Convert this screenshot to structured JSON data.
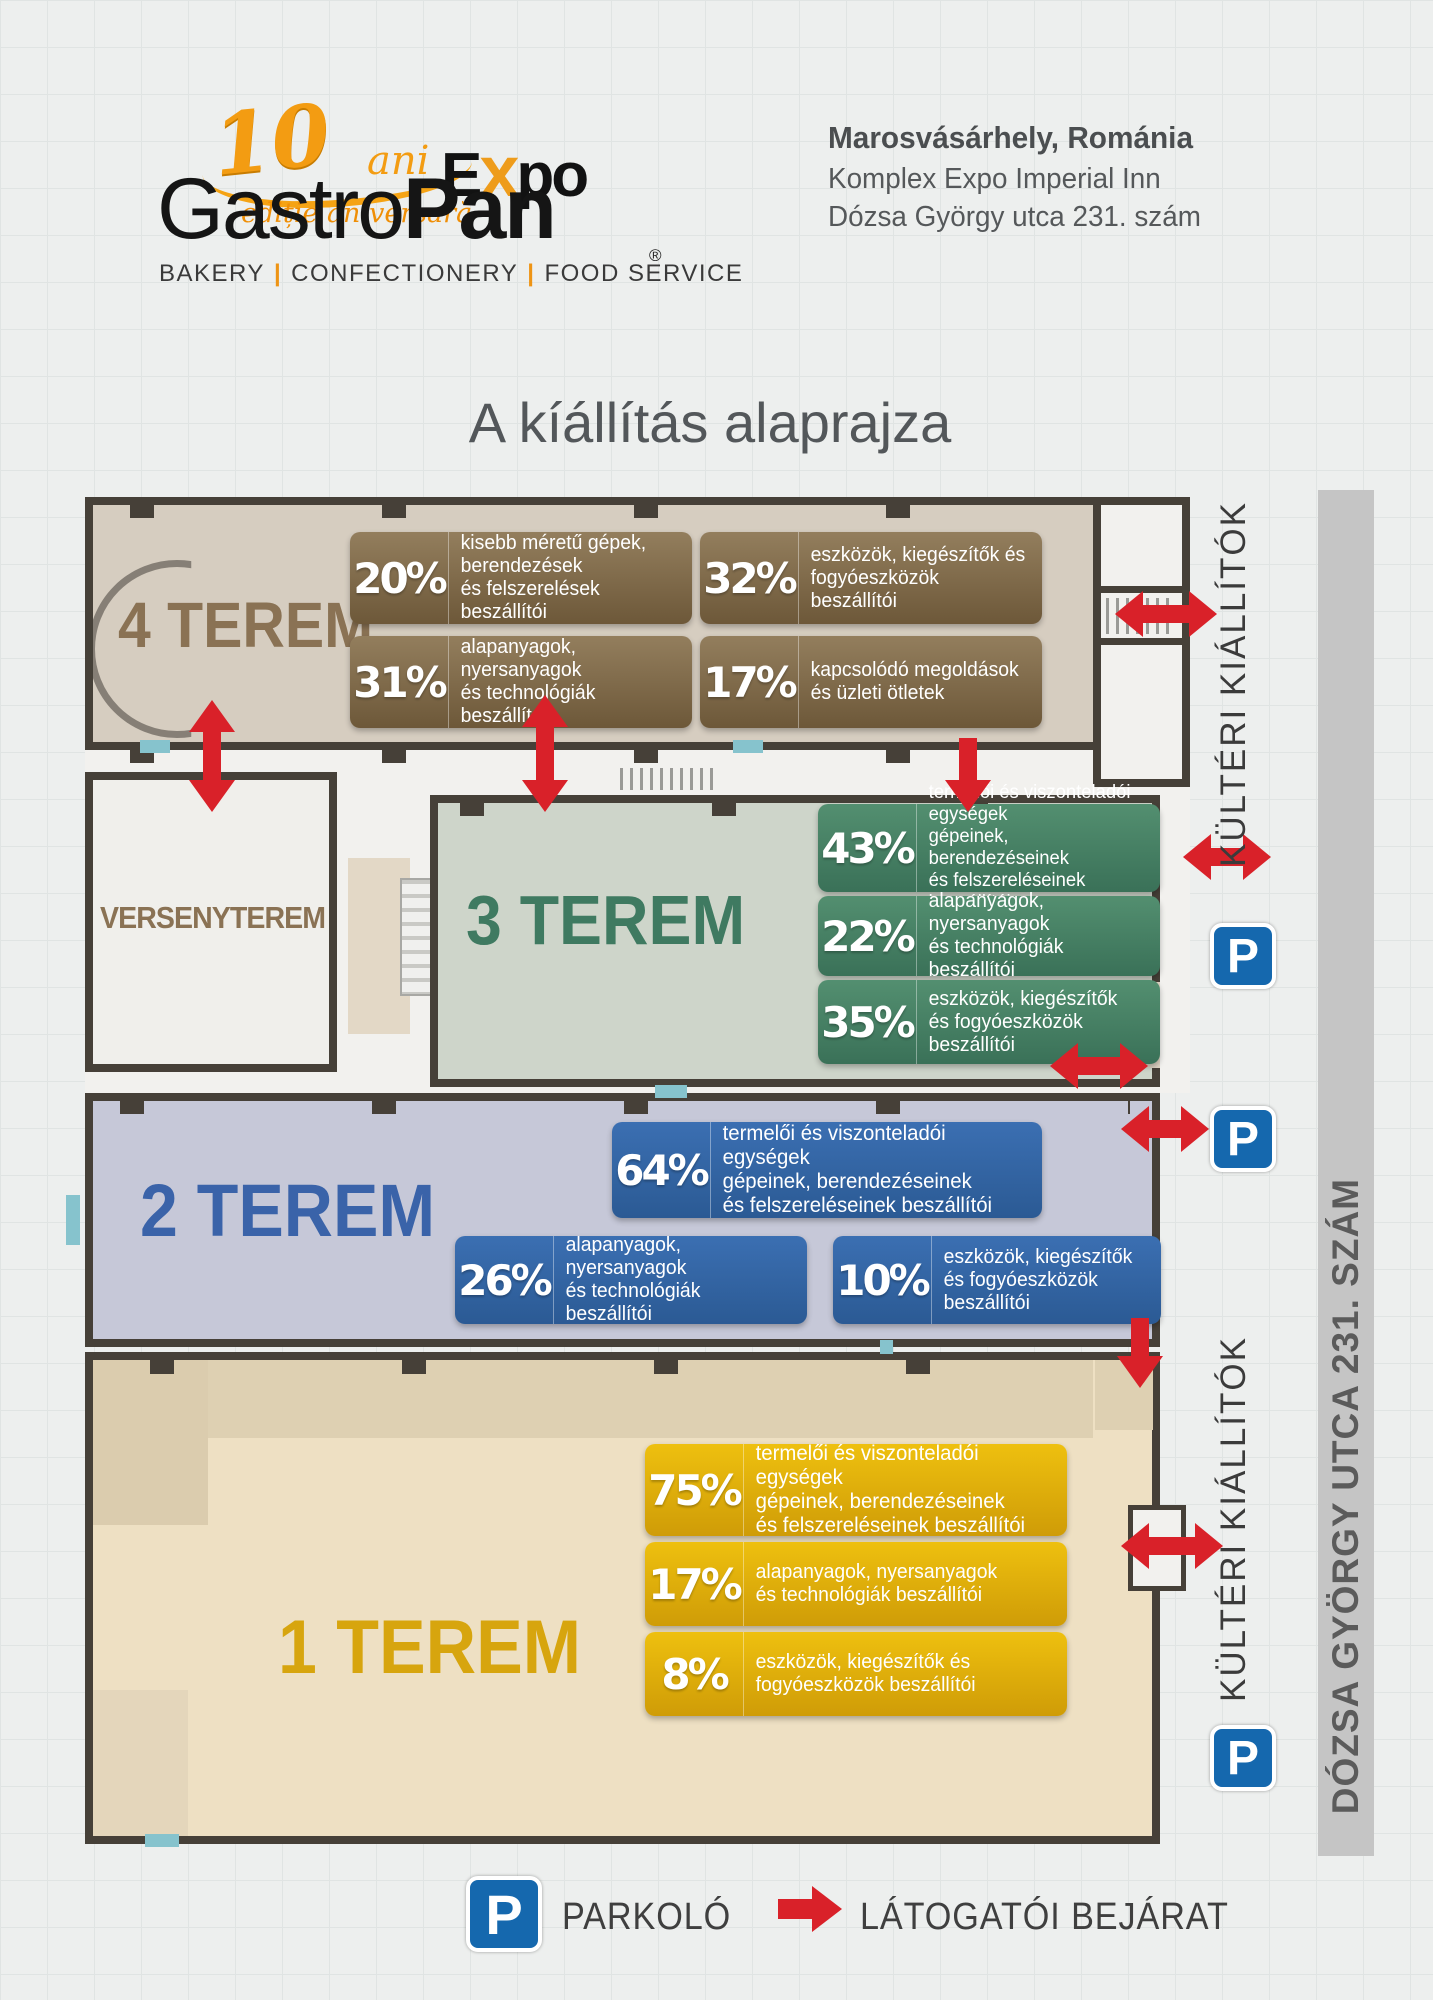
{
  "header": {
    "logo": {
      "anniv_number": "10",
      "anniv_word": "ani",
      "anniv_edition": "ediție aniversară",
      "expo_e": "E",
      "expo_x": "x",
      "expo_po": "po",
      "registered": "®",
      "brand_gastro": "Gastro",
      "brand_pan": "Pan",
      "tagline_1": "BAKERY",
      "tagline_2": "CONFECTIONERY",
      "tagline_3": "FOOD SERVICE",
      "tagline_sep": "|"
    },
    "address": {
      "city": "Marosvásárhely, Románia",
      "venue": "Komplex Expo Imperial Inn",
      "street": "Dózsa György utca 231. szám"
    }
  },
  "title": "A kíállítás alaprajza",
  "halls": {
    "hall4": {
      "name": "4 TEREM",
      "stats": [
        {
          "pct": "20%",
          "label": "kisebb méretű gépek, berendezések\nés felszerelések beszállítói"
        },
        {
          "pct": "32%",
          "label": "eszközök, kiegészítők és\nfogyóeszközök beszállítói"
        },
        {
          "pct": "31%",
          "label": "alapanyagok, nyersanyagok\nés technológiák beszállítói"
        },
        {
          "pct": "17%",
          "label": "kapcsolódó megoldások\nés üzleti ötletek"
        }
      ]
    },
    "versenyterem": {
      "name": "VERSENYTEREM"
    },
    "hall3": {
      "name": "3 TEREM",
      "stats": [
        {
          "pct": "43%",
          "label": "termelői és viszonteladói egységek\ngépeinek, berendezéseinek\nés felszereléseinek beszállítói"
        },
        {
          "pct": "22%",
          "label": "alapanyagok, nyersanyagok\nés technológiák beszállítói"
        },
        {
          "pct": "35%",
          "label": "eszközök, kiegészítők\nés fogyóeszközök beszállítói"
        }
      ]
    },
    "hall2": {
      "name": "2 TEREM",
      "stats": [
        {
          "pct": "64%",
          "label": "termelői és viszonteladói egységek\ngépeinek, berendezéseinek\nés felszereléseinek beszállítói"
        },
        {
          "pct": "26%",
          "label": "alapanyagok, nyersanyagok\nés technológiák beszállítói"
        },
        {
          "pct": "10%",
          "label": "eszközök, kiegészítők\nés fogyóeszközök beszállítói"
        }
      ]
    },
    "hall1": {
      "name": "1 TEREM",
      "stats": [
        {
          "pct": "75%",
          "label": "termelői és viszonteladói egységek\ngépeinek, berendezéseinek\nés felszereléseinek beszállítói"
        },
        {
          "pct": "17%",
          "label": "alapanyagok, nyersanyagok\nés technológiák beszállítói"
        },
        {
          "pct": "8%",
          "label": "eszközök, kiegészítők és\nfogyóeszközök beszállítói"
        }
      ]
    }
  },
  "side": {
    "outdoor_top": "KÜLTÉRI KIÁLLÍTÓK",
    "outdoor_bottom": "KÜLTÉRI KIÁLLÍTÓK",
    "street_bar": "DÓZSA GYÖRGY UTCA 231. SZÁM"
  },
  "legend": {
    "parking_symbol": "P",
    "parking_label": "PARKOLÓ",
    "entrance_label": "LÁTOGATÓI BEJÁRAT"
  },
  "colors": {
    "accent_red": "#d92129",
    "parking_blue": "#1568ae",
    "hall4_brown": "#8a7254",
    "hall3_green": "#3f7a61",
    "hall2_blue": "#3a63a9",
    "hall1_yellow": "#d7a50e"
  }
}
